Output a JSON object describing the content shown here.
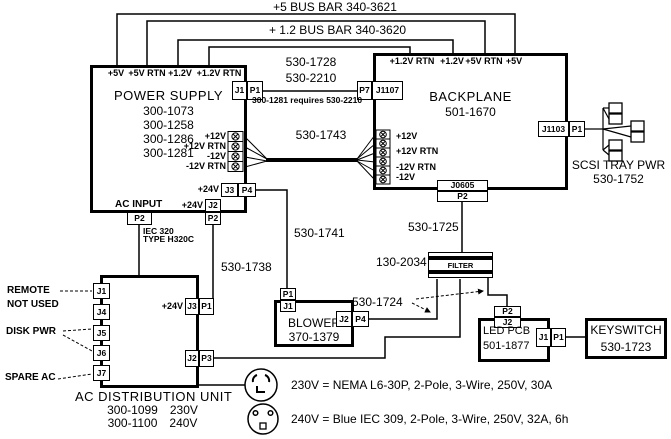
{
  "diagram": {
    "bus_bars": {
      "plus5": "+5 BUS BAR 340-3621",
      "plus12": "+ 1.2 BUS BAR 340-3620"
    },
    "power_supply": {
      "title": "POWER SUPPLY",
      "models": [
        "300-1073",
        "300-1258",
        "300-1286",
        "300-1281"
      ],
      "top_pins": [
        "+5V",
        "+5V RTN",
        "+1.2V",
        "+1.2V RTN"
      ],
      "dc_pins": [
        "+12V",
        "+12V RTN",
        "-12V",
        "-12V RTN"
      ],
      "connectors": {
        "j1": "J1",
        "p1": "P1",
        "j3": "J3",
        "p4": "P4",
        "j2": "J2",
        "p2_24v": "P2",
        "p2_ac": "P2"
      },
      "labels": {
        "ac_input": "AC INPUT",
        "plus24_bottom": "+24V",
        "plus24_j3": "+24V",
        "iec_line1": "IEC 320",
        "iec_line2": "TYPE H320C"
      }
    },
    "backplane": {
      "title": "BACKPLANE",
      "model": "501-1670",
      "top_pins": [
        "+1.2V RTN",
        "+1.2V",
        "+5V RTN",
        "+5V"
      ],
      "dc_pins": [
        "+12V",
        "+12V RTN",
        "-12V RTN",
        "-12V"
      ],
      "connectors": {
        "p7": "P7",
        "j1107": "J1107",
        "j1103": "J1103",
        "p1": "P1",
        "j0605": "J0605",
        "p2": "P2"
      }
    },
    "scsi_tray": {
      "line1": "SCSI TRAY PWR",
      "line2": "530-1752"
    },
    "ac_unit": {
      "title": "AC DISTRIBUTION UNIT",
      "models": [
        {
          "pn": "300-1099",
          "voltage": "230V"
        },
        {
          "pn": "300-1100",
          "voltage": "240V"
        }
      ],
      "left_ports": [
        "J1",
        "J4",
        "J5",
        "J6",
        "J7"
      ],
      "labels": {
        "remote": "REMOTE",
        "not_used": "NOT USED",
        "disk_pwr": "DISK PWR",
        "spare_ac": "SPARE AC",
        "plus24": "+24V"
      },
      "connectors": {
        "j3": "J3",
        "p1": "P1",
        "j2": "J2",
        "p3": "P3"
      }
    },
    "blower": {
      "title": "BLOWER",
      "model": "370-1379",
      "connectors": {
        "p1": "P1",
        "j1": "J1",
        "j2": "J2",
        "p4": "P4"
      }
    },
    "filter": {
      "label": "FILTER",
      "part": "130-2034"
    },
    "led_pcb": {
      "title": "LED PCB",
      "model": "501-1877",
      "connectors": {
        "p2": "P2",
        "j2": "J2",
        "j1": "J1",
        "p1": "P1"
      }
    },
    "keyswitch": {
      "title": "KEYSWITCH",
      "model": "530-1723"
    },
    "cables": {
      "c1728": "530-1728",
      "c2210": "530-2210",
      "note_1281": "300-1281 requires 530-2210",
      "c1743": "530-1743",
      "c1741": "530-1741",
      "c1738": "530-1738",
      "c1725": "530-1725",
      "c1724": "530-1724"
    },
    "notes": {
      "v230": "230V = NEMA L6-30P, 2-Pole, 3-Wire, 250V, 30A",
      "v240": "240V = Blue IEC 309, 2-Pole, 3-Wire, 250V, 32A, 6h"
    }
  }
}
